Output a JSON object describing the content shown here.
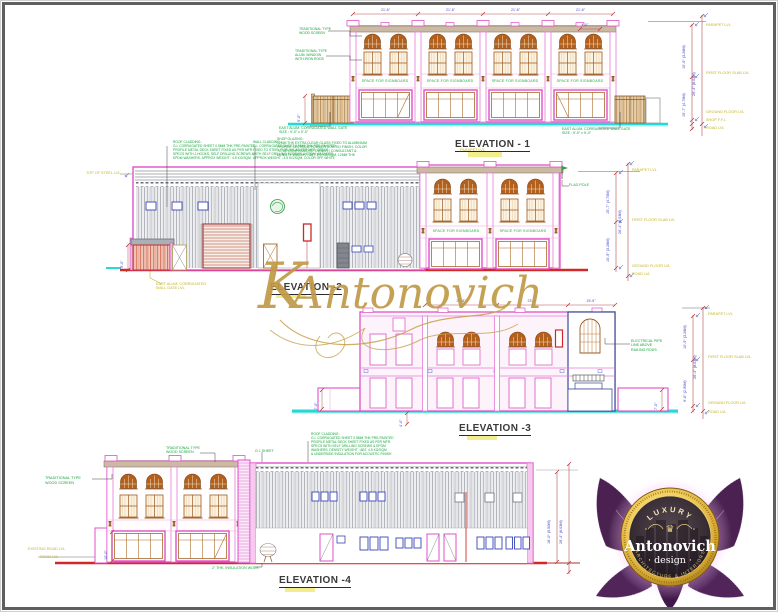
{
  "titles": {
    "e1": "ELEVATION - 1",
    "e2": "ELEVATION -2",
    "e3": "ELEVATION -3",
    "e4": "ELEVATION -4"
  },
  "signboard": "SPACE FOR SIGNBOARD",
  "levels": {
    "parapet": "PARAPET LVL",
    "first": "FIRST FLOOR SLAB LVL",
    "ground": "GROUND FLOOR LVL",
    "road": "ROAD LVL",
    "shop": "SHOP F.F.L.",
    "steel": "TOP OF STEEL LVL",
    "exroad": "EXISTING ROAD LVL"
  },
  "dims": {
    "h1": "10'-9\" (3.28M)",
    "h2": "15'-7\" (4.75M)",
    "total": "26'-4\" (8.03M)",
    "mid": "9'-6\" (2.90M)",
    "wh": "18'-0\" (5.50M)",
    "gate": "9'-0\"",
    "bay": "21'-6\"",
    "wing": "7'-0\"",
    "small": "4'-0\"",
    "low": "10'-0\"",
    "b1": "23'-8\"",
    "b2": "15'-5\""
  },
  "notes": {
    "e1_screen": "TRADITIONAL TYPE\nWOOD SCREEN",
    "e1_alum": "TRADITIONAL TYPE\nALUM. WINDOW\nWITH IRON RODS",
    "e1_gate": "EAST ALUM. CORRUGATED WALL GATE\nSIZE : 9'-0\" x 9'-0\"",
    "e1_spec": "SHOP GLAZING :\n12MM THK EXTRA CLEAR GLASS FIXED TO ALUMINIUM\nPROFILE SECTIONS POWDER COATED FINISH, COLOR\nTO BE CONFIRMED BY OWNER / CONSULTANT &\nDENSITY WEIGHT : ABT. 2.5 KG/SQM, 12MM THK",
    "e2_spec1": "ROOF CLADDING :\nG.I. CORRUGATED SHEET 0.5MM THK PRE-PAINTED\nPROFILE METAL DECK SHEET FIXED AS PER MFR.\nSPECS WITH J-HOOKS, SELF DRILLING SCREWS &\nEPDM WASHERS. APPROX WEIGHT : 4.5 KG/SQM",
    "e2_spec2": "WALL CLADDING :\nG.I. CORRUGATED SHEET 0.5MM THK PRE-PAINTED\nFIXED TO STEEL PURLINS AS PER MFR. SPECS\nWITH SELF DRILLING SCREWS & EPDM WASHERS.\nAPPROX WEIGHT : 4.5 KG/SQM, COLOR OFF WHITE",
    "e2_flag": "FLAG POLE",
    "e2_gate": "EAST ALUM. CORRUGATED\nWALL GATE LVL",
    "e3_elec": "ELECTRICAL PIPE\nLINE ABOVE\nRAILING RODS",
    "e4_spec": "ROOF CLADDING :\nG.I. CORRUGATED SHEET 0.5MM THK PRE-PAINTED\nPROFILE METAL DECK SHEET FIXED AS PER MFR.\nSPECS WITH SELF DRILLING SCREWS & EPDM\nWASHERS. DENSITY WEIGHT : ABT. 4.5 KG/SQM\n& UNDERSIDE INSULATION FOR ACOUSTIC FINISH",
    "e4_screen": "TRADITIONAL TYPE\nWOOD SCREEN",
    "e4_gis": "G.I. SHEET",
    "e4_insul": "2\" THK. INSULATION WORK"
  },
  "watermark": {
    "initial": "K",
    "name": "Antonovich"
  },
  "logo": {
    "top": "LUXURY",
    "name": "Antonovich",
    "design": "· design ·",
    "tagline": "ARCHITECTURE & INTERIORS",
    "crown": "♛"
  },
  "colors": {
    "outline_magenta": "#e050c8",
    "window_brown": "#b2601c",
    "annotation_green": "#17a33b",
    "level_yellow": "#c6b224",
    "dim_blue": "#4347c6",
    "ground_cyan": "#28d8d4",
    "ground_red": "#d42828",
    "gold": "#c09a46",
    "lotus_purple": "#4a2150"
  }
}
